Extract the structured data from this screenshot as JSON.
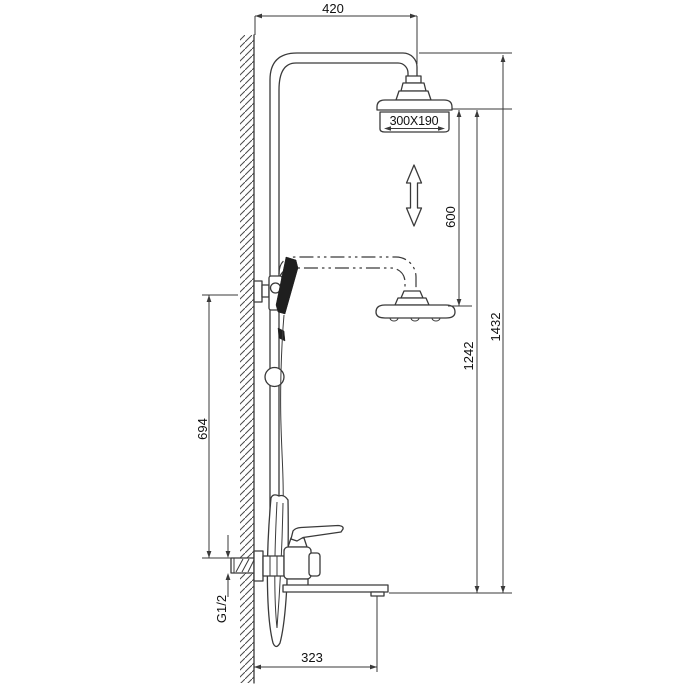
{
  "page": {
    "background": "#ffffff"
  },
  "colors": {
    "line": "#3a3a3a",
    "text": "#111111",
    "dark_fill": "#1f1f1f"
  },
  "dims": {
    "top_offset": "420",
    "head_size": "300X190",
    "height_adjust": "600",
    "head_height": "1242",
    "total_height": "1432",
    "bracket_height": "694",
    "inlet_thread": "G1/2",
    "spout_reach": "323"
  }
}
